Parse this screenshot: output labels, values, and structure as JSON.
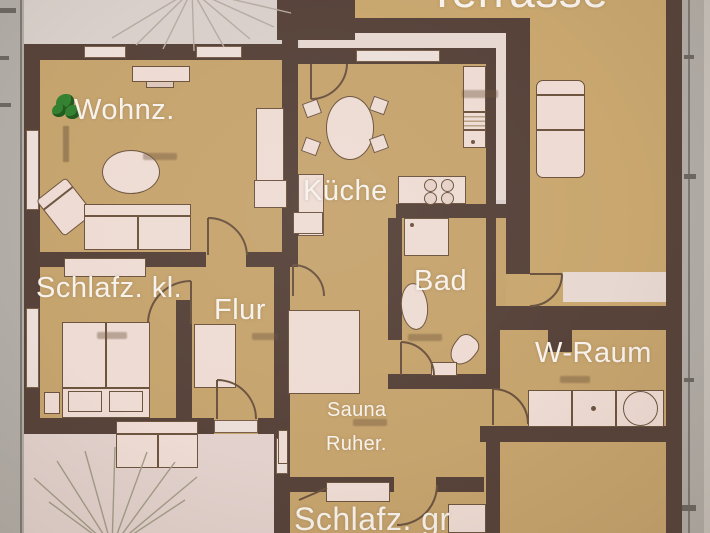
{
  "document_type": "residential-floor-plan",
  "labels": {
    "terrasse": "Terrasse",
    "wohnzimmer": "Wohnz.",
    "kueche": "Küche",
    "bad": "Bad",
    "schlafzimmer_klein": "Schlafz. kl.",
    "flur": "Flur",
    "wraum": "W-Raum",
    "sauna_line1": "Sauna",
    "sauna_line2": "Ruher.",
    "schlafzimmer_gross": "Schlafz. gr"
  },
  "colors": {
    "wall": "#57433a",
    "room_floor": "#c6a46e",
    "terrace_floor": "#c9a76f",
    "furniture_fill": "#eedcd4",
    "furniture_line": "#6d543f",
    "outdoor_ground": "#e2d1cc",
    "background": "#d9d0cb",
    "ruler_strip": "#b2ada7",
    "label_text": "#f8f2ec",
    "plant_green": "#348231"
  },
  "symbols": [
    "plant",
    "rug-oval",
    "sofa",
    "armchair",
    "tv-board",
    "wall-unit",
    "sideboard",
    "dining-table",
    "dining-chair",
    "kitchen-counter",
    "stove",
    "dishwasher",
    "kitchen-sink",
    "shower",
    "bathtub",
    "toilet",
    "washbasin",
    "utility-counter",
    "washing-machine",
    "double-bed",
    "wardrobe",
    "hall-closet",
    "nightstand",
    "sauna-lounger",
    "wall-shelf",
    "cabinet",
    "terrace-lounger",
    "garden-sofa",
    "tree",
    "door-arc",
    "window"
  ]
}
